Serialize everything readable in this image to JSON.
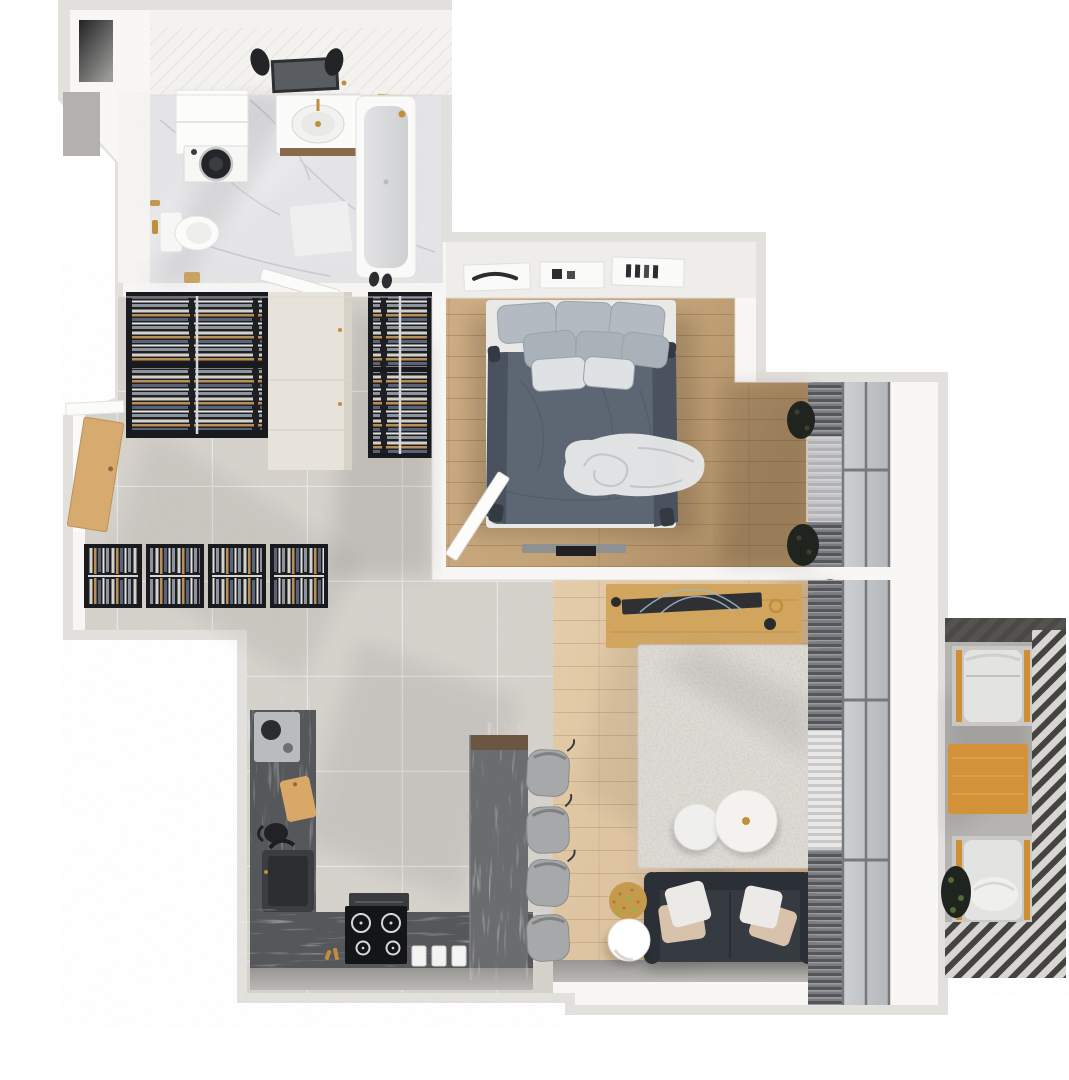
{
  "meta": {
    "kind": "3d-apartment-floor-plan",
    "view": "top-down-render",
    "text_visible": "none"
  },
  "colors": {
    "page_bg": "#ffffff",
    "wall_outer": "#e3e1dd",
    "wall_inner": "#f8f7f5",
    "wall_face": "#efedea",
    "block_dark": "#b3b1ae",
    "shaft_dark": "#2e2e2f",
    "tile_floor": "#d5d2cc",
    "tile_line": "#e7e5e1",
    "marble_floor": "#e5e5e8",
    "marble_vein": "#bcbec6",
    "bath_tile_wall": "#f3f2ef",
    "wood_bedroom": "#c9a87e",
    "wood_living": "#dfc6a3",
    "counter_marble": "#55575a",
    "counter_bar": "#6a6c6e",
    "counter_brown": "#6b5643",
    "bed_frame": "#e9e9e8",
    "bed_duvet": "#5d6774",
    "bed_duvet_dark": "#49525e",
    "pillow_gray": "#b3bac1",
    "pillow_mid": "#a9b1b9",
    "pillow_light": "#dfe2e5",
    "throw_white": "#e6e7e8",
    "sofa": "#363b42",
    "sofa_dark": "#2b3036",
    "cushion_white": "#eceae6",
    "cushion_beige": "#d9c2ab",
    "rug": "#dedbd5",
    "console_wood": "#d2a55e",
    "tv_dark": "#2e3033",
    "table_white": "#f3f2ef",
    "gold": "#c08f3a",
    "pouf_gold": "#c59a4d",
    "stool_gray": "#a6a8aa",
    "balcony_floor": "#b6b4b1",
    "railing_dark": "#45433f",
    "railing_gap": "#d8d6d3",
    "lounger_cushion": "#e3e3e1",
    "lounger_orange": "#d18f35",
    "side_table_orange": "#d49238",
    "blinds_dark": "#54565a",
    "blinds_mid": "#8f9194",
    "glass": "#c5c8ca",
    "frame_dark": "#77797c",
    "plant_dark": "#20241f",
    "plant_green": "#7cc22d",
    "appliance_black": "#141517",
    "appliance_steel": "#b9bbbd",
    "washer_door": "#232528",
    "closet_box": "#191a1d",
    "dresser_beige": "#e7e3da",
    "door_wood": "#d7ab6f",
    "door_white": "#fcfcfb",
    "white": "#ffffff",
    "mirror": "#595c60",
    "tub_inner": "#d9dadb",
    "cutting_board": "#d9a867",
    "floor_strip_shadow": "#a8a6a3"
  },
  "rooms": {
    "bathroom": {
      "label": "bathroom",
      "items": [
        "shower-head",
        "shower-head",
        "mirror",
        "vanity-sink",
        "storage-cabinet",
        "washing-machine",
        "toilet",
        "bathtub",
        "bath-mat",
        "slippers",
        "towel-hook",
        "open-door"
      ]
    },
    "hallway": {
      "label": "hallway",
      "items": [
        "entry-door",
        "tall-wardrobe-left",
        "beige-dresser",
        "tall-wardrobe-right",
        "wardrobe-row-unit",
        "wardrobe-row-unit",
        "wardrobe-row-unit",
        "wardrobe-row-unit"
      ]
    },
    "bedroom": {
      "label": "bedroom",
      "items": [
        "double-bed",
        "pillows",
        "duvet",
        "throw-blanket",
        "wall-shelf",
        "wall-shelf",
        "wall-shelf",
        "wall-tv",
        "open-door",
        "window-blinds",
        "sheer-curtain",
        "plant",
        "plant"
      ]
    },
    "living_room": {
      "label": "living-room",
      "items": [
        "tv-console",
        "flat-tv",
        "decor",
        "plant",
        "area-rug",
        "coffee-table-large",
        "coffee-table-small",
        "sofa",
        "cushions",
        "gold-pouf",
        "sphere-floor-lamp",
        "window-blinds",
        "glass-wall"
      ]
    },
    "kitchen": {
      "label": "kitchen",
      "items": [
        "coffee-machine",
        "cutting-board",
        "kettle",
        "sink",
        "faucet",
        "cooktop",
        "extractor-hood",
        "jars",
        "green-plant",
        "bar-counter",
        "bar-stool",
        "bar-stool",
        "bar-stool",
        "bar-stool"
      ]
    },
    "balcony": {
      "label": "balcony",
      "items": [
        "lounge-chair",
        "wood-side-table",
        "lounge-chair",
        "plant",
        "slatted-railing"
      ]
    }
  }
}
